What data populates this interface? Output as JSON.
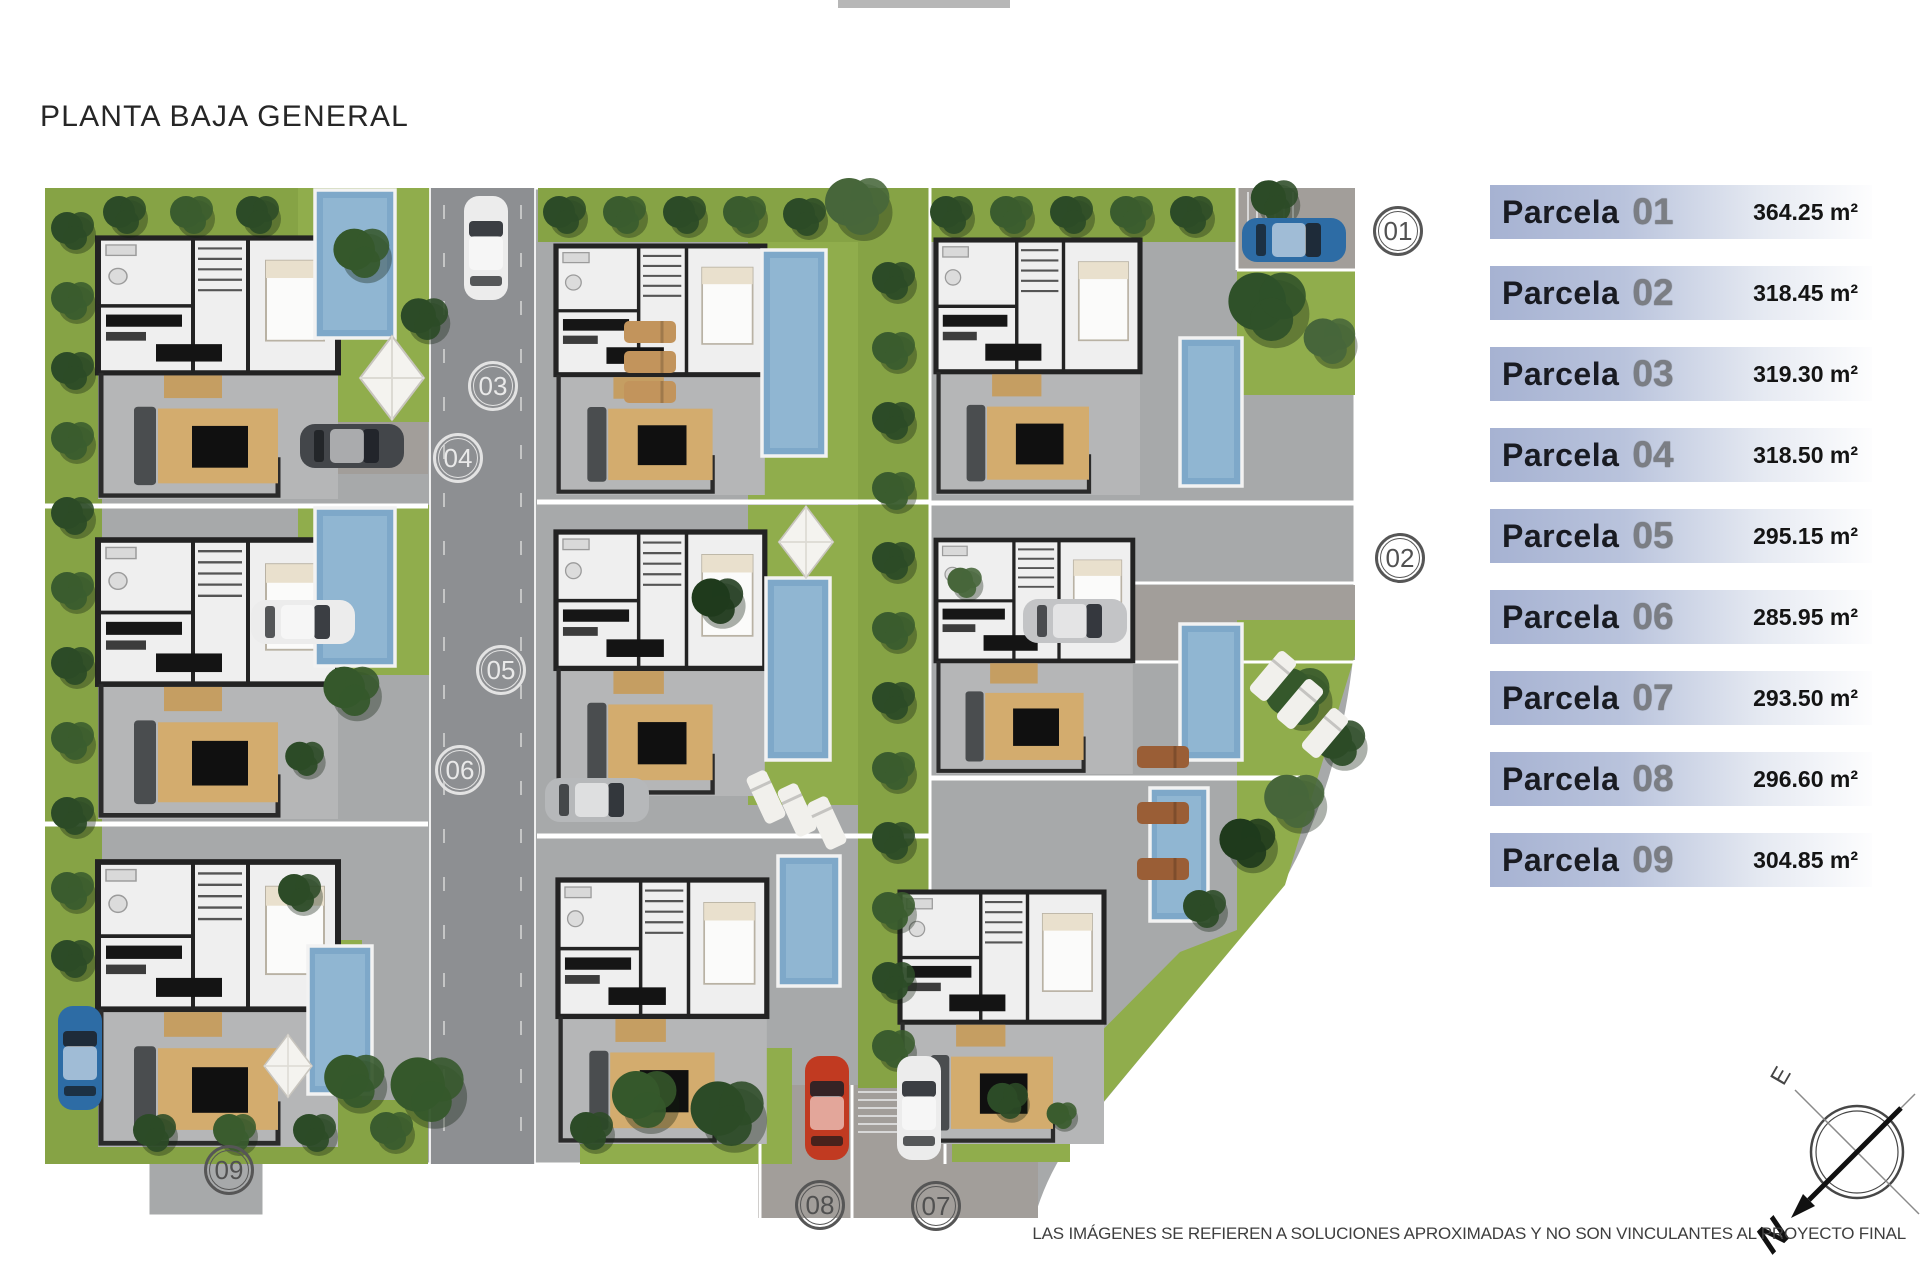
{
  "title": "PLANTA BAJA GENERAL",
  "legend": {
    "items": [
      {
        "label": "Parcela",
        "number": "01",
        "area": "364.25 m²"
      },
      {
        "label": "Parcela",
        "number": "02",
        "area": "318.45 m²"
      },
      {
        "label": "Parcela",
        "number": "03",
        "area": "319.30 m²"
      },
      {
        "label": "Parcela",
        "number": "04",
        "area": "318.50 m²"
      },
      {
        "label": "Parcela",
        "number": "05",
        "area": "295.15 m²"
      },
      {
        "label": "Parcela",
        "number": "06",
        "area": "285.95 m²"
      },
      {
        "label": "Parcela",
        "number": "07",
        "area": "293.50 m²"
      },
      {
        "label": "Parcela",
        "number": "08",
        "area": "296.60 m²"
      },
      {
        "label": "Parcela",
        "number": "09",
        "area": "304.85 m²"
      }
    ]
  },
  "plan": {
    "markers": [
      {
        "label": "01"
      },
      {
        "label": "02"
      },
      {
        "label": "03"
      },
      {
        "label": "04"
      },
      {
        "label": "05"
      },
      {
        "label": "06"
      },
      {
        "label": "07"
      },
      {
        "label": "08"
      },
      {
        "label": "09"
      }
    ]
  },
  "compass": {
    "north": "N",
    "east": "E",
    "south": "S",
    "west": "O"
  },
  "footer": {
    "disclaimer": "LAS IMÁGENES SE REFIEREN A SOLUCIONES APROXIMADAS Y NO SON VINCULANTES AL PROYECTO FINAL"
  },
  "colors": {
    "legend_bar": "#a6b2d2",
    "road": "#8d8f92",
    "paving": "#a7a9aa",
    "lawn": "#90ad4c",
    "pool": "#7ea8c9",
    "tree": "#2c4b27"
  }
}
